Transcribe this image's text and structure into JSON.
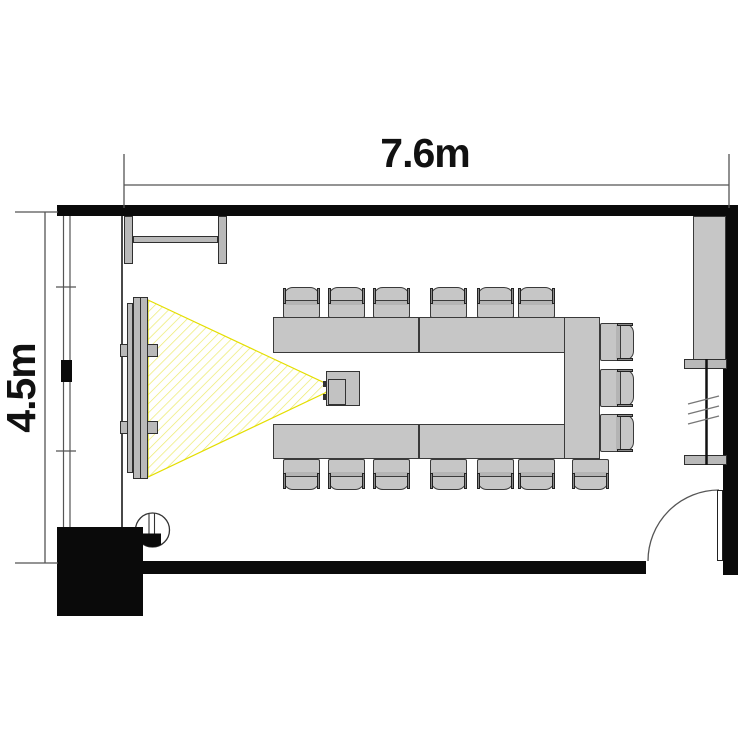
{
  "title": "Conference room floor plan",
  "dimensions": {
    "width_label": "7.6m",
    "depth_label": "4.5m"
  },
  "furniture": {
    "chairs": {
      "top": {
        "y": 287,
        "xs": [
          283,
          328,
          373,
          430,
          477,
          518
        ]
      },
      "bottom": {
        "y": 459,
        "xs": [
          283,
          328,
          373,
          430,
          477,
          518,
          572
        ]
      },
      "right": {
        "left": 598,
        "tops": [
          325,
          371,
          416
        ]
      }
    },
    "counts": {
      "chairs_total": 16,
      "table_segments": 5
    }
  },
  "colors": {
    "wall": "#0a0a0a",
    "furniture_fill": "#c6c6c6",
    "furniture_border": "#3a3a3a",
    "beam_edge": "#e4de00",
    "beam_hatch": "#ecea6a"
  }
}
